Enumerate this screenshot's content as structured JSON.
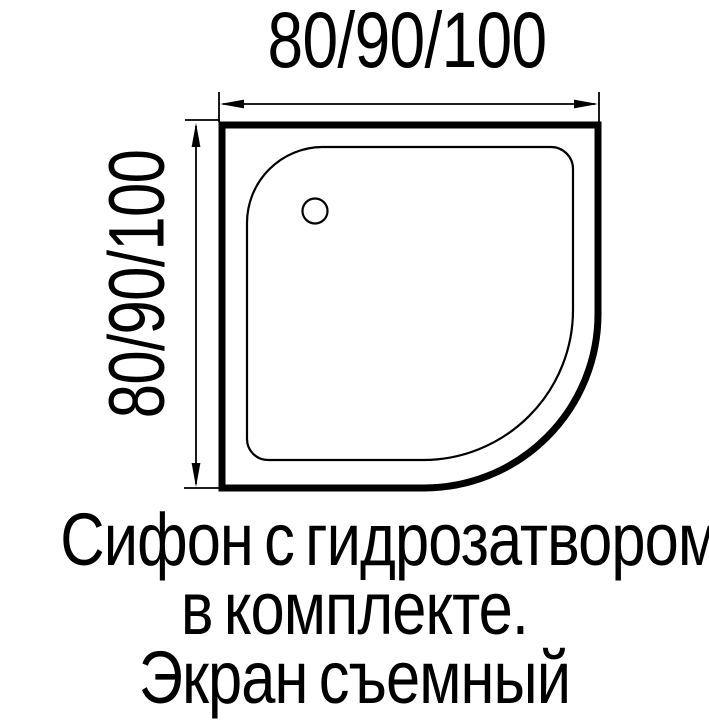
{
  "diagram": {
    "background_color": "#ffffff",
    "line_color": "#000000",
    "subject": "quarter-round shower tray top view",
    "width_dimension_label": "80/90/100",
    "height_dimension_label": "80/90/100"
  },
  "caption": {
    "line1": "Сифон с гидрозатвором",
    "line2": "в комплекте.",
    "line3": "Экран съемный"
  }
}
